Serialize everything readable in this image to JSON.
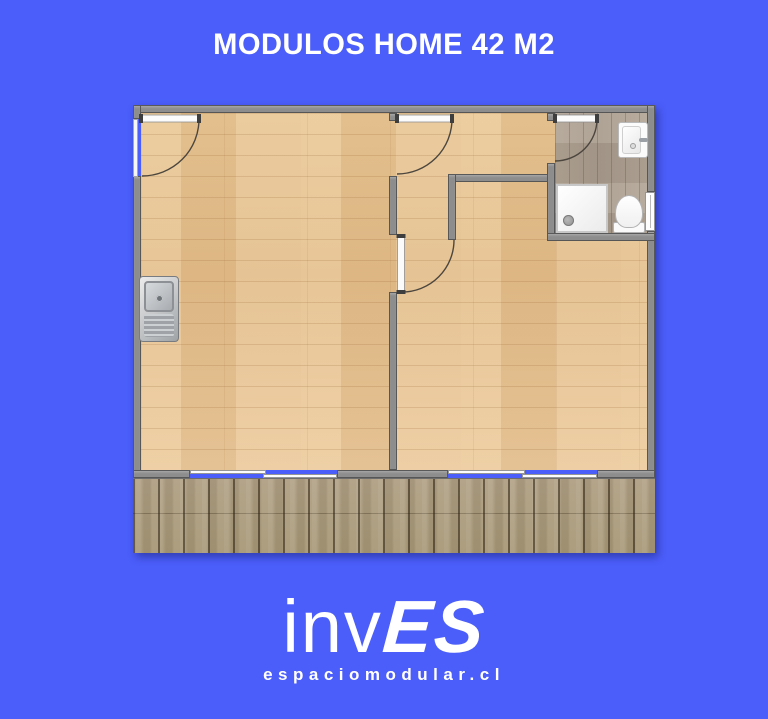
{
  "header": {
    "title": "MODULOS HOME 42 M2"
  },
  "footer": {
    "logo_light": "inv",
    "logo_bold": "ES",
    "logo_subtitle": "espaciomodular.cl"
  },
  "floorplan": {
    "fixtures": [
      "kitchen-sink",
      "washbasin",
      "shower-tray",
      "toilet"
    ],
    "door_count": 4,
    "window_count": 3,
    "areas": [
      "main-room",
      "bedroom",
      "bathroom",
      "hallway",
      "deck"
    ]
  },
  "colors": {
    "bg": "#4b5efa",
    "wall": "#8d8d8d",
    "floor_main": "#e9c795",
    "floor_bath": "#b2a595",
    "deck": "#b0a084",
    "text": "#ffffff"
  }
}
